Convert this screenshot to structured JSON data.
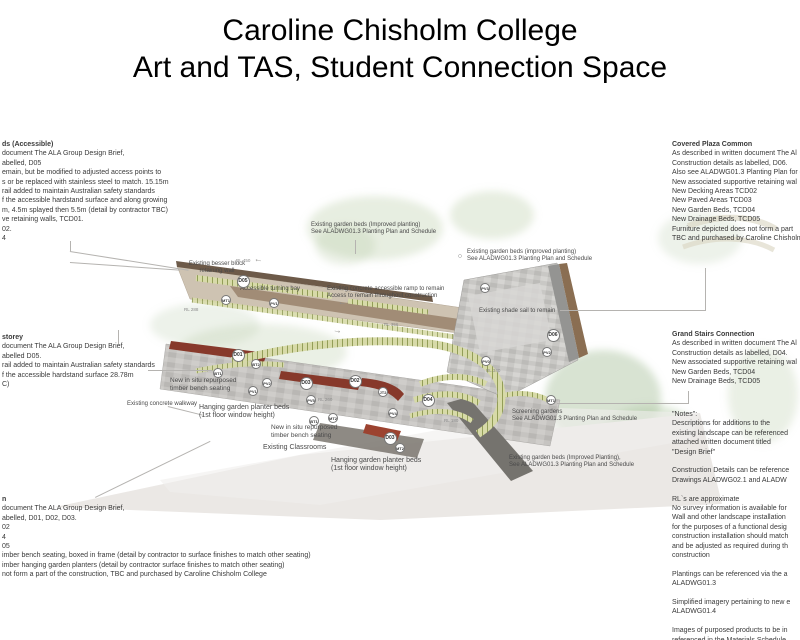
{
  "title": {
    "line1": "Caroline Chisholm College",
    "line2": "Art and TAS, Student Connection Space"
  },
  "colors": {
    "terracotta": "#87392b",
    "bed_green": "#d7daa8",
    "ramp_tan": "#cec3b2",
    "wall_brown": "#6d5a49",
    "plaza_gray": "#c9c8c5"
  },
  "annotations": {
    "left_top": {
      "heading": "ds (Accessible)",
      "lines": [
        "document The ALA Group Design Brief,",
        "abelled, D05",
        "emain, but be modified to adjusted access points to",
        "s or be replaced with stainless steel to match. 15.15m",
        "rail added to maintain Australian safety standards",
        "f the accessible hardstand surface and along growing",
        "m, 4.5m splayed then 5.5m (detail by contractor TBC)",
        "ve retaining walls, TCD01.",
        "02.",
        "4"
      ]
    },
    "left_mid": {
      "heading": "storey",
      "lines": [
        "document The ALA Group Design Brief,",
        "abelled D05.",
        "rail added to maintain Australian safety standards",
        "f the accessible hardstand surface 28.78m",
        "C)"
      ]
    },
    "left_bottom": {
      "heading": "n",
      "lines": [
        "document The ALA Group Design Brief,",
        "abelled, D01, D02, D03.",
        "02",
        "4",
        "05",
        "imber bench seating, boxed in frame (detail by contractor to surface finishes to match other seating)",
        "imber hanging garden planters (detail by contractor surface finishes to match other seating)",
        "not form a part of the construction, TBC and purchased by Caroline Chisholm College"
      ]
    },
    "right_top": {
      "heading": "Covered Plaza Common",
      "lines": [
        "As described in written document The Al",
        "Construction details as labelled, D06.",
        "Also see ALADWG01.3 Planting Plan for g",
        "New associated supportive retaining wal",
        "New Decking Areas TCD02",
        "New Paved Areas TCD03",
        "New Garden Beds, TCD04",
        "New Drainage Beds, TCD05",
        "Furniture depicted does not form a part",
        "TBC and purchased by Caroline Chisholm"
      ]
    },
    "right_mid": {
      "heading": "Grand Stairs Connection",
      "lines": [
        "As described in written document The Al",
        "Construction details as labelled, D04.",
        "New associated supportive retaining wal",
        "New Garden Beds, TCD04",
        "New Drainage Beds, TCD05"
      ]
    },
    "notes": {
      "lines": [
        "\"Notes\":",
        "Descriptions for additions to the",
        "existing landscape can be referenced",
        "attached written document titled",
        "\"Design Brief\"",
        "",
        "Construction Details can be reference",
        "Drawings ALADWG02.1 and ALADW",
        "",
        "RL`s are approximate",
        "No survey information is available for",
        "Wall and other landscape installation",
        "for the purposes of a functional desig",
        "construction installation should match",
        "and be adjusted as required during th",
        "construction",
        "",
        "Plantings can be referenced via the a",
        "ALADWG01.3",
        "",
        "Simplified imagery pertaining to new e",
        "ALADWG01.4",
        "",
        "Images of purposed products to be in",
        "referenced in the Materials Schedule"
      ]
    }
  },
  "plan": {
    "labels": [
      {
        "text": "Existing garden beds (Improved planting)\nSee ALADWG01.3 Planting Plan and Schedule",
        "x": 311,
        "y": 222
      },
      {
        "text": "Existing besser block\nretaining wall",
        "x": 179,
        "y": 261,
        "w": 76,
        "align": "center"
      },
      {
        "text": "Accessible turning bay",
        "x": 240,
        "y": 286
      },
      {
        "text": "Existing concrete accessible ramp to remain\nAccess to remain throughout construction",
        "x": 327,
        "y": 286
      },
      {
        "text": "Existing garden beds (improved planting)\nSee ALADWG01.3 Planting Plan and Schedule",
        "x": 467,
        "y": 249
      },
      {
        "text": "Existing shade sail to remain",
        "x": 479,
        "y": 308
      },
      {
        "text": "New in situ repurposed\ntimber bench seating",
        "x": 170,
        "y": 377,
        "size": 6.5
      },
      {
        "text": "Existing concrete walkway",
        "x": 127,
        "y": 401
      },
      {
        "text": "Hanging garden planter beds\n(1st floor window height)",
        "x": 199,
        "y": 404,
        "size": 7
      },
      {
        "text": "New in situ repurposed\ntimber bench seating",
        "x": 271,
        "y": 424,
        "size": 6.5
      },
      {
        "text": "Existing Classrooms",
        "x": 263,
        "y": 444,
        "size": 7
      },
      {
        "text": "Hanging garden planter beds\n(1st floor window height)",
        "x": 331,
        "y": 457,
        "size": 7
      },
      {
        "text": "Screening gardens\nSee ALADWG01.3 Planting Plan and Schedule",
        "x": 512,
        "y": 409
      },
      {
        "text": "Existing garden beds (Improved Planting),\nSee ALADWG01.3 Planting Plan and Schedule",
        "x": 509,
        "y": 455
      }
    ],
    "rl_levels": [
      {
        "text": "RL 450",
        "x": 236,
        "y": 258
      },
      {
        "text": "RL 288",
        "x": 184,
        "y": 307
      },
      {
        "text": "RL 356",
        "x": 384,
        "y": 322
      },
      {
        "text": "RL 340",
        "x": 486,
        "y": 368
      },
      {
        "text": "RL 260",
        "x": 318,
        "y": 397
      },
      {
        "text": "RL 180",
        "x": 444,
        "y": 418
      }
    ],
    "markers": [
      {
        "label": "D05",
        "x": 243,
        "y": 281
      },
      {
        "label": "MT1",
        "x": 226,
        "y": 300
      },
      {
        "label": "PV1",
        "x": 274,
        "y": 303
      },
      {
        "label": "D01",
        "x": 238,
        "y": 355
      },
      {
        "label": "BT2",
        "x": 256,
        "y": 364
      },
      {
        "label": "BT1",
        "x": 218,
        "y": 373
      },
      {
        "label": "PV2",
        "x": 267,
        "y": 383
      },
      {
        "label": "PV1",
        "x": 253,
        "y": 391
      },
      {
        "label": "D03",
        "x": 306,
        "y": 383
      },
      {
        "label": "D02",
        "x": 355,
        "y": 381
      },
      {
        "label": "JT2",
        "x": 383,
        "y": 392
      },
      {
        "label": "PV5",
        "x": 311,
        "y": 400
      },
      {
        "label": "D04",
        "x": 428,
        "y": 400
      },
      {
        "label": "PV4",
        "x": 393,
        "y": 413
      },
      {
        "label": "BT1",
        "x": 314,
        "y": 421
      },
      {
        "label": "MT2",
        "x": 333,
        "y": 418
      },
      {
        "label": "D03",
        "x": 390,
        "y": 438
      },
      {
        "label": "MT2",
        "x": 400,
        "y": 448
      },
      {
        "label": "PV3",
        "x": 485,
        "y": 288
      },
      {
        "label": "PV0",
        "x": 486,
        "y": 361
      },
      {
        "label": "D06",
        "x": 553,
        "y": 335
      },
      {
        "label": "PV2",
        "x": 547,
        "y": 352
      },
      {
        "label": "MT1",
        "x": 551,
        "y": 400
      }
    ],
    "arrows": [
      {
        "glyph": "←",
        "x": 254,
        "y": 255,
        "rotate": 10
      },
      {
        "glyph": "←",
        "x": 338,
        "y": 298,
        "rotate": 10
      },
      {
        "glyph": "→",
        "x": 333,
        "y": 326,
        "rotate": 10
      }
    ],
    "leader_lines": [
      {
        "x": 70,
        "y": 241,
        "w": 1,
        "h": 10
      },
      {
        "x": 70,
        "y": 251,
        "w": 120,
        "rotate": 9
      },
      {
        "x": 70,
        "y": 262,
        "w": 110,
        "rotate": 4
      },
      {
        "x": 148,
        "y": 370,
        "w": 64
      },
      {
        "x": 118,
        "y": 330,
        "w": 1,
        "h": 14
      },
      {
        "x": 168,
        "y": 406,
        "w": 36,
        "rotate": 14
      },
      {
        "x": 95,
        "y": 497,
        "w": 128,
        "rotate": -26
      },
      {
        "x": 355,
        "y": 240,
        "w": 1,
        "h": 14
      },
      {
        "x": 705,
        "y": 268,
        "w": 1,
        "h": 43
      },
      {
        "x": 560,
        "y": 310,
        "w": 146
      },
      {
        "x": 557,
        "y": 403,
        "w": 132
      },
      {
        "x": 688,
        "y": 391,
        "w": 1,
        "h": 13
      }
    ]
  }
}
